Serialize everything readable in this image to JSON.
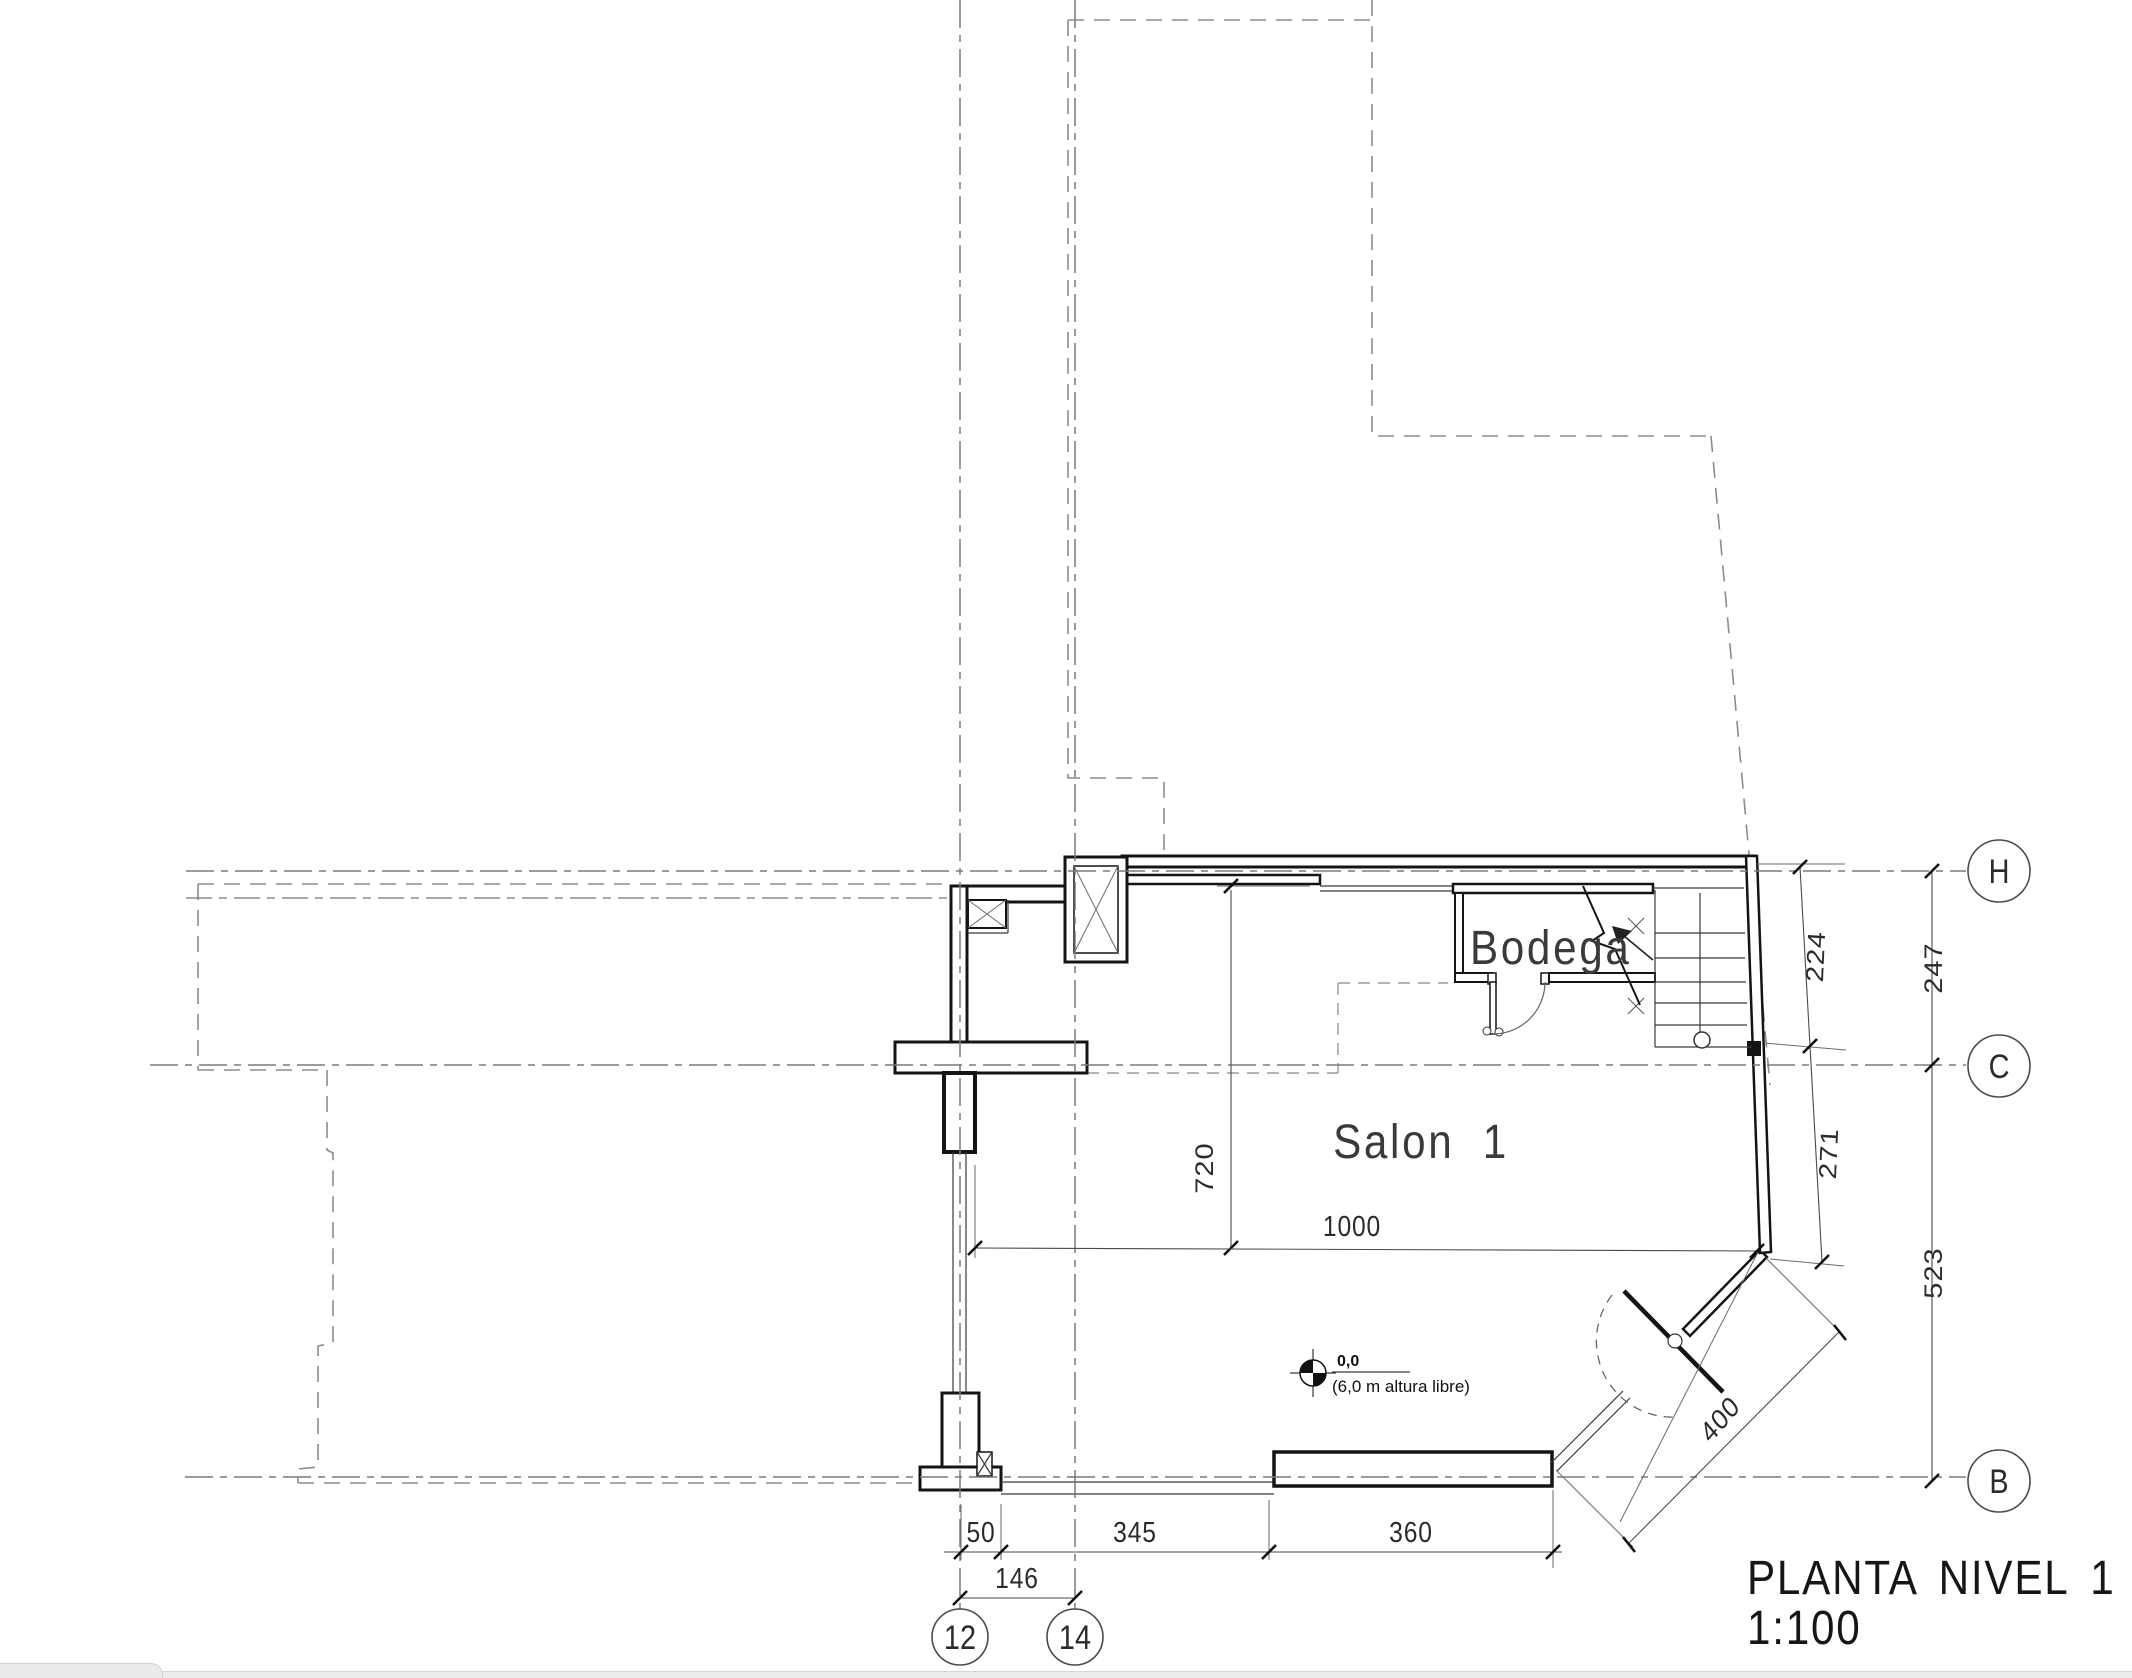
{
  "title": {
    "name": "PLANTA NIVEL 1",
    "scale": "1:100"
  },
  "rooms": {
    "salon": "Salon 1",
    "bodega": "Bodega"
  },
  "datum": {
    "elevation": "0,0",
    "note": "(6,0 m altura libre)"
  },
  "dims": {
    "d50": "50",
    "d345": "345",
    "d360": "360",
    "d146": "146",
    "d720": "720",
    "d1000": "1000",
    "d224": "224",
    "d247": "247",
    "d271": "271",
    "d523": "523",
    "d400": "400"
  },
  "bubbles": {
    "b12": "12",
    "b14": "14",
    "bH": "H",
    "bC": "C",
    "bB": "B"
  },
  "colors": {
    "paper": "#ffffff",
    "line_dark": "#141414",
    "line_grid": "#7a7a7a",
    "line_site": "#8c8c8c",
    "chrome_gray": "#ececee"
  }
}
